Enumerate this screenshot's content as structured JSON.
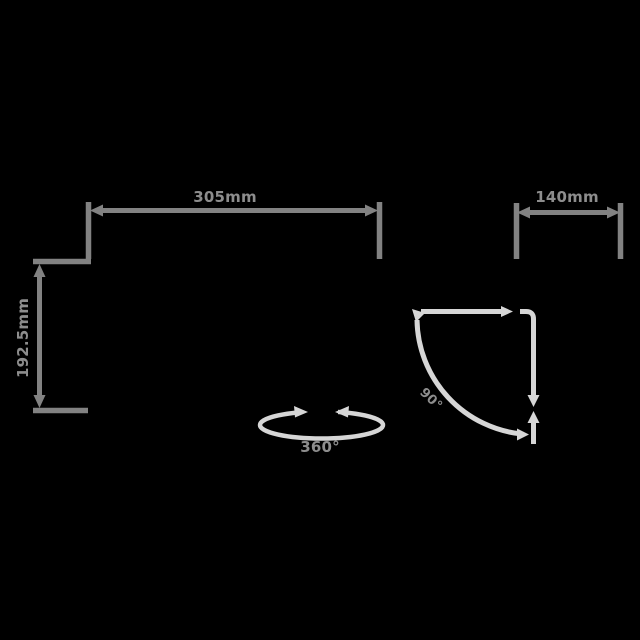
{
  "title": "Product dimension diagram",
  "colors": {
    "bg": "#000000",
    "dim_gray": "#828282",
    "light_gray": "#d6d6d6",
    "label_gray": "#8d8d8d"
  },
  "dimensions": {
    "width_top": {
      "label": "305mm"
    },
    "height_left": {
      "label": "192.5mm"
    },
    "depth_right": {
      "label": "140mm"
    },
    "corner_angle": {
      "label": "90°"
    },
    "rotation": {
      "label": "360°"
    }
  }
}
